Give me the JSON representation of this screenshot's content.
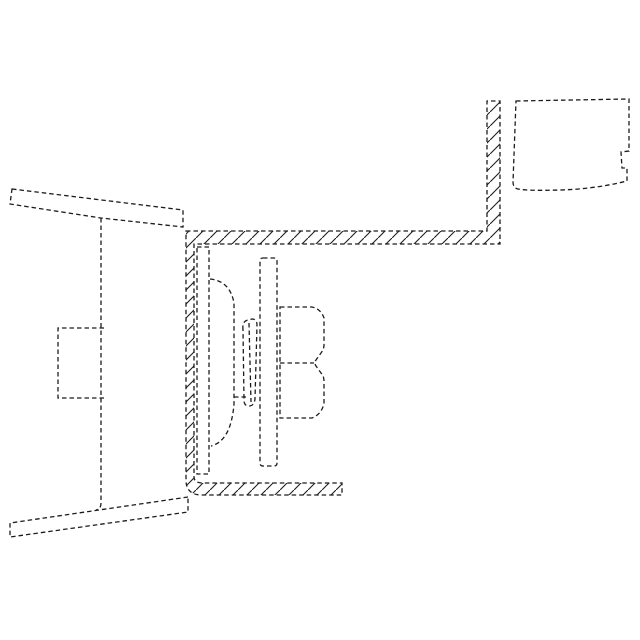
{
  "canvas": {
    "width": 640,
    "height": 640,
    "background": "#ffffff"
  },
  "style": {
    "line_color": "#1c1c1c",
    "stroke_width": 1.3,
    "dash_pattern": "4.5 3",
    "hatch_color": "#1c1c1c",
    "hatch_stroke_width": 1.1,
    "hatch_spacing": 14
  },
  "figure": {
    "description": "Cross-section technical drawing: loudspeaker assembly mounted in a hatched C-channel bracket between dashed panel outlines",
    "parts": [
      {
        "name": "outer-panel-upper-arm",
        "type": "dashed-closed",
        "d": "M 12,189 L 183,210 L 183,227 L 101,218 L 10,204 Z"
      },
      {
        "name": "outer-panel-inner-line",
        "type": "dashed-open",
        "d": "M 101,218 L 101,503 Q 101,509 96,510"
      },
      {
        "name": "panel-pocket-rect",
        "type": "dashed-open",
        "d": "M 104,328 L 58,328 L 58,398 L 104,398"
      },
      {
        "name": "outer-panel-lower-arm",
        "type": "dashed-closed",
        "d": "M 188,497 L 10,523 L 10,537 L 188,512 Z"
      },
      {
        "name": "enclosure-bracket",
        "type": "hatched-closed",
        "d": "M 186,231 L 487,231 L 487,101 L 500,101 L 500,244 L 194,244 L 194,477 Q 194,483 203,483 L 342,483 L 342,495 L 202,495 Q 186,495 186,480 Z"
      },
      {
        "name": "speaker-frame-strip",
        "type": "dashed-closed",
        "d": "M 197,247 L 209,247 L 209,474 L 197,474 Z"
      },
      {
        "name": "speaker-diaphragm",
        "type": "dashed-open",
        "d": "M 210,279 Q 230,281 234,303 L 234,404 Q 231,441 211,446"
      },
      {
        "name": "voice-coil-outer",
        "type": "dashed-closed",
        "d": "M 243,330 Q 242,321 248,320 L 252,319 Q 257,319 257,325 L 255,399 Q 254,406 249,406 Q 244,406 244,400 Z"
      },
      {
        "name": "voice-coil-inner-line",
        "type": "dashed-open",
        "d": "M 249,323 L 251,402"
      },
      {
        "name": "voice-coil-tick",
        "type": "dashed-open",
        "d": "M 234,397 L 248,397"
      },
      {
        "name": "frame-bar",
        "type": "dashed-closed",
        "d": "M 263,258 L 274,258 Q 277,258 277,261 L 277,463 Q 277,466 274,466 L 263,466 Q 260,466 260,463 L 260,261 Q 260,258 263,258 Z"
      },
      {
        "name": "magnet-assembly",
        "type": "dashed-closed",
        "d": "M 280,307 L 312,307 Q 321,309 324,318 L 324,345 Q 324,349 321,353 L 316,360 Q 314,363 316,366 L 321,373 Q 324,376 324,381 L 324,403 Q 322,414 312,418 L 280,418 Z"
      },
      {
        "name": "magnet-mid-line",
        "type": "dashed-open",
        "d": "M 280,363 L 314,363"
      },
      {
        "name": "trim-box",
        "type": "dashed-closed",
        "d": "M 516,101 L 629,99 L 629,151 L 621,152 L 622,168 L 627,168 L 627,181 Q 595,189 560,190 Q 528,191 518,189 Q 513,188 513,182 Z"
      }
    ]
  }
}
